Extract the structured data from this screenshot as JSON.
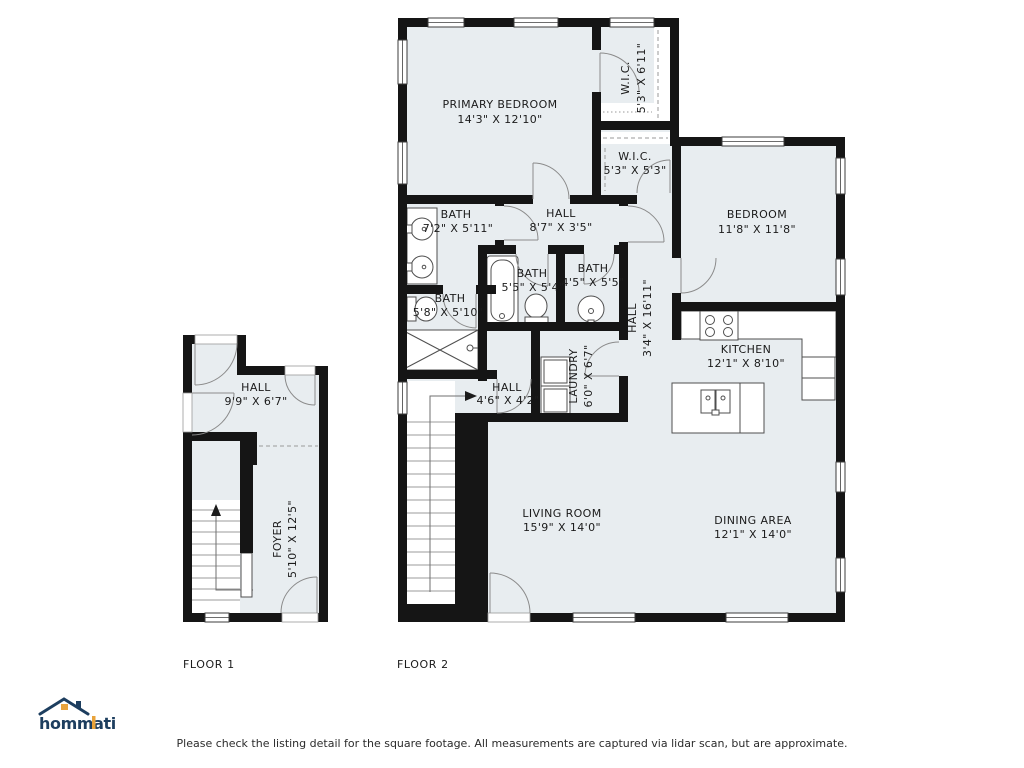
{
  "colors": {
    "room_fill": "#e8edf0",
    "wall": "#151515",
    "door_stroke": "#8b8b8b",
    "fixture_stroke": "#4f4f4f",
    "tread_stroke": "#9b9b9b",
    "text": "#1b1b1b",
    "logo_navy": "#1d3e5f",
    "logo_orange": "#e9a33b"
  },
  "floors": {
    "floor1": {
      "label": "FLOOR 1",
      "rooms": {
        "hall": {
          "name": "HALL",
          "dims": "9'9\" X 6'7\""
        },
        "foyer": {
          "name": "FOYER",
          "dims": "5'10\" X 12'5\""
        }
      }
    },
    "floor2": {
      "label": "FLOOR 2",
      "rooms": {
        "primary_bedroom": {
          "name": "PRIMARY BEDROOM",
          "dims": "14'3\" X 12'10\""
        },
        "wic_primary": {
          "name": "W.I.C.",
          "dims": "5'3\" X 6'11\""
        },
        "wic_second": {
          "name": "W.I.C.",
          "dims": "5'3\" X 5'3\""
        },
        "bedroom": {
          "name": "BEDROOM",
          "dims": "11'8\" X 11'8\""
        },
        "bath_primary": {
          "name": "BATH",
          "dims": "7'2\" X 5'11\""
        },
        "hall_upper": {
          "name": "HALL",
          "dims": "8'7\" X 3'5\""
        },
        "bath_tub": {
          "name": "BATH",
          "dims": "5'5\" X 5'4\""
        },
        "bath_powder": {
          "name": "BATH",
          "dims": "4'5\" X 5'5\""
        },
        "bath_shower": {
          "name": "BATH",
          "dims": "5'8\" X 5'10\""
        },
        "hall_long": {
          "name": "HALL",
          "dims": "3'4\" X 16'11\""
        },
        "kitchen": {
          "name": "KITCHEN",
          "dims": "12'1\" X 8'10\""
        },
        "laundry": {
          "name": "LAUNDRY",
          "dims": "6'0\" X 6'7\""
        },
        "hall_small": {
          "name": "HALL",
          "dims": "4'6\" X 4'2\""
        },
        "living_room": {
          "name": "LIVING ROOM",
          "dims": "15'9\" X 14'0\""
        },
        "dining_area": {
          "name": "DINING AREA",
          "dims": "12'1\" X 14'0\""
        }
      }
    }
  },
  "branding": {
    "logo_text": "hommati"
  },
  "footer": {
    "disclaimer": "Please check the listing detail for the square footage. All measurements are captured via lidar scan, but are approximate."
  }
}
